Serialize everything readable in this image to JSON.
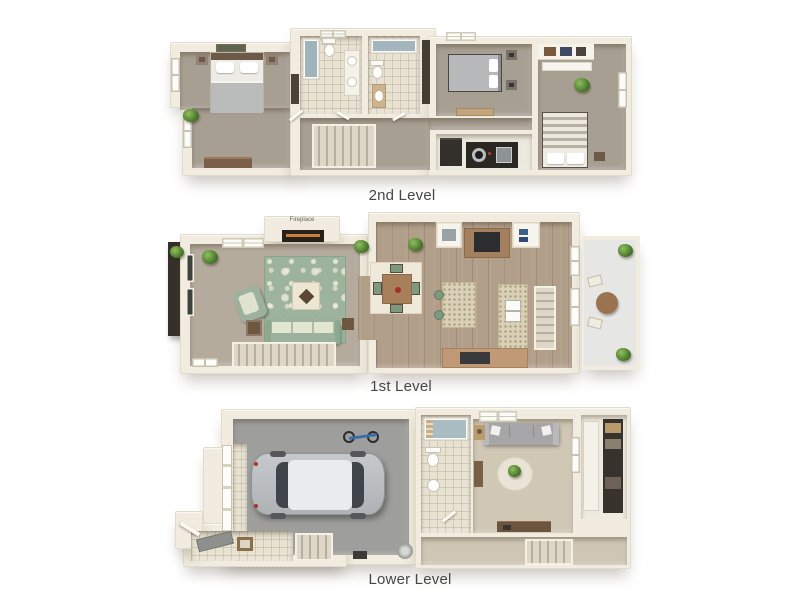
{
  "image": {
    "type": "3d-floor-plan",
    "background": "#ffffff",
    "units_shown": 3
  },
  "floors": [
    {
      "id": "2nd-level",
      "label": "2nd Level",
      "rooms": [
        "master-bedroom",
        "walk-in-closet",
        "bathroom-1",
        "bathroom-2",
        "hallway",
        "staircase",
        "bedroom-2",
        "laundry-closet",
        "bedroom-3"
      ]
    },
    {
      "id": "1st-level",
      "label": "1st Level",
      "fireplace_label": "Fireplace",
      "rooms": [
        "entry-porch",
        "living-room",
        "staircase-down",
        "dining-area",
        "kitchen",
        "staircase-up",
        "balcony"
      ]
    },
    {
      "id": "lower-level",
      "label": "Lower Level",
      "rooms": [
        "garage",
        "entry-hall",
        "bathroom",
        "den",
        "storage-closet",
        "staircase"
      ]
    }
  ],
  "colors": {
    "background": "#ffffff",
    "wall_cream": "#f1ecdf",
    "carpet_taupe": "#a89f93",
    "tile_beige": "#e8e2d3",
    "wood_floor": "#b19f8a",
    "sage_green": "#9cb29e",
    "granite_counter": "#d9d0b7",
    "counter_tan": "#c09a76",
    "garage_gray": "#9e9e9c",
    "appliance_dark": "#2b2824",
    "label_text": "#474747"
  }
}
